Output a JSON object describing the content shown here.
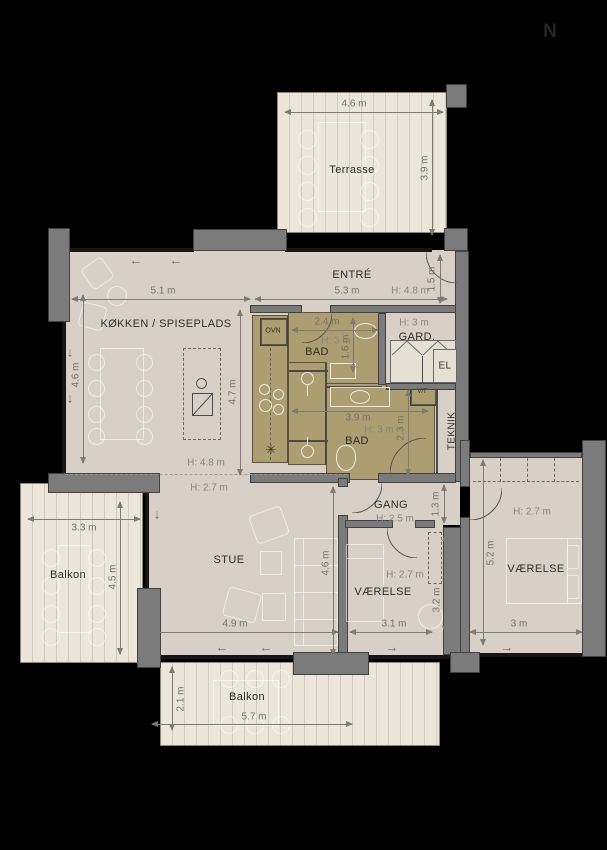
{
  "north": {
    "label": "N"
  },
  "palette": {
    "background": "#000000",
    "wall": "#7b7b7b",
    "floor": "#d8d0c7",
    "deck": "#ece6da",
    "wet_zone": "#ac9e70",
    "dimension_text": "#75716b",
    "room_label": "#2f2c27"
  },
  "rooms": {
    "terrasse": {
      "label": "Terrasse",
      "width": "4.6 m",
      "depth": "3.9 m"
    },
    "entre": {
      "label": "ENTRÉ",
      "width": "5.3 m",
      "ceiling": "H: 4.8 m",
      "niche": "1.5 m"
    },
    "koekken": {
      "label": "KØKKEN / SPISEPLADS",
      "width": "5.1 m",
      "depth": "4.6 m",
      "island_depth": "4.7 m"
    },
    "ceiling_break": {
      "high": "H: 4.8 m",
      "low": "H: 2.7 m"
    },
    "bad_1": {
      "label": "BAD",
      "width": "2.4 m",
      "ceiling": "H: 3 m",
      "depth": "1.6 m"
    },
    "bad_2": {
      "label": "BAD",
      "width": "3.9 m",
      "ceiling": "H: 3 m",
      "depth": "2.3 m"
    },
    "gard": {
      "label": "GARD.",
      "ceiling": "H: 3 m"
    },
    "el": {
      "label": "EL"
    },
    "teknik": {
      "label": "TEKNIK"
    },
    "vt": {
      "label": "V/T"
    },
    "ovn": {
      "label": "OVN"
    },
    "stue": {
      "label": "STUE",
      "width": "4.9 m",
      "depth": "4.6 m"
    },
    "gang": {
      "label": "GANG",
      "ceiling": "H: 2.5 m",
      "width": "1.3 m"
    },
    "vaerelse_1": {
      "label": "VÆRELSE",
      "ceiling": "H: 2.7 m",
      "width": "3.1 m",
      "depth": "3.2 m"
    },
    "vaerelse_2": {
      "label": "VÆRELSE",
      "ceiling": "H: 2.7 m",
      "width": "3 m",
      "depth": "5.2 m"
    },
    "balkon_left": {
      "label": "Balkon",
      "width": "3.3 m",
      "depth": "4.5 m"
    },
    "balkon_bottom": {
      "label": "Balkon",
      "width": "5.7 m",
      "depth": "2.1 m"
    }
  }
}
